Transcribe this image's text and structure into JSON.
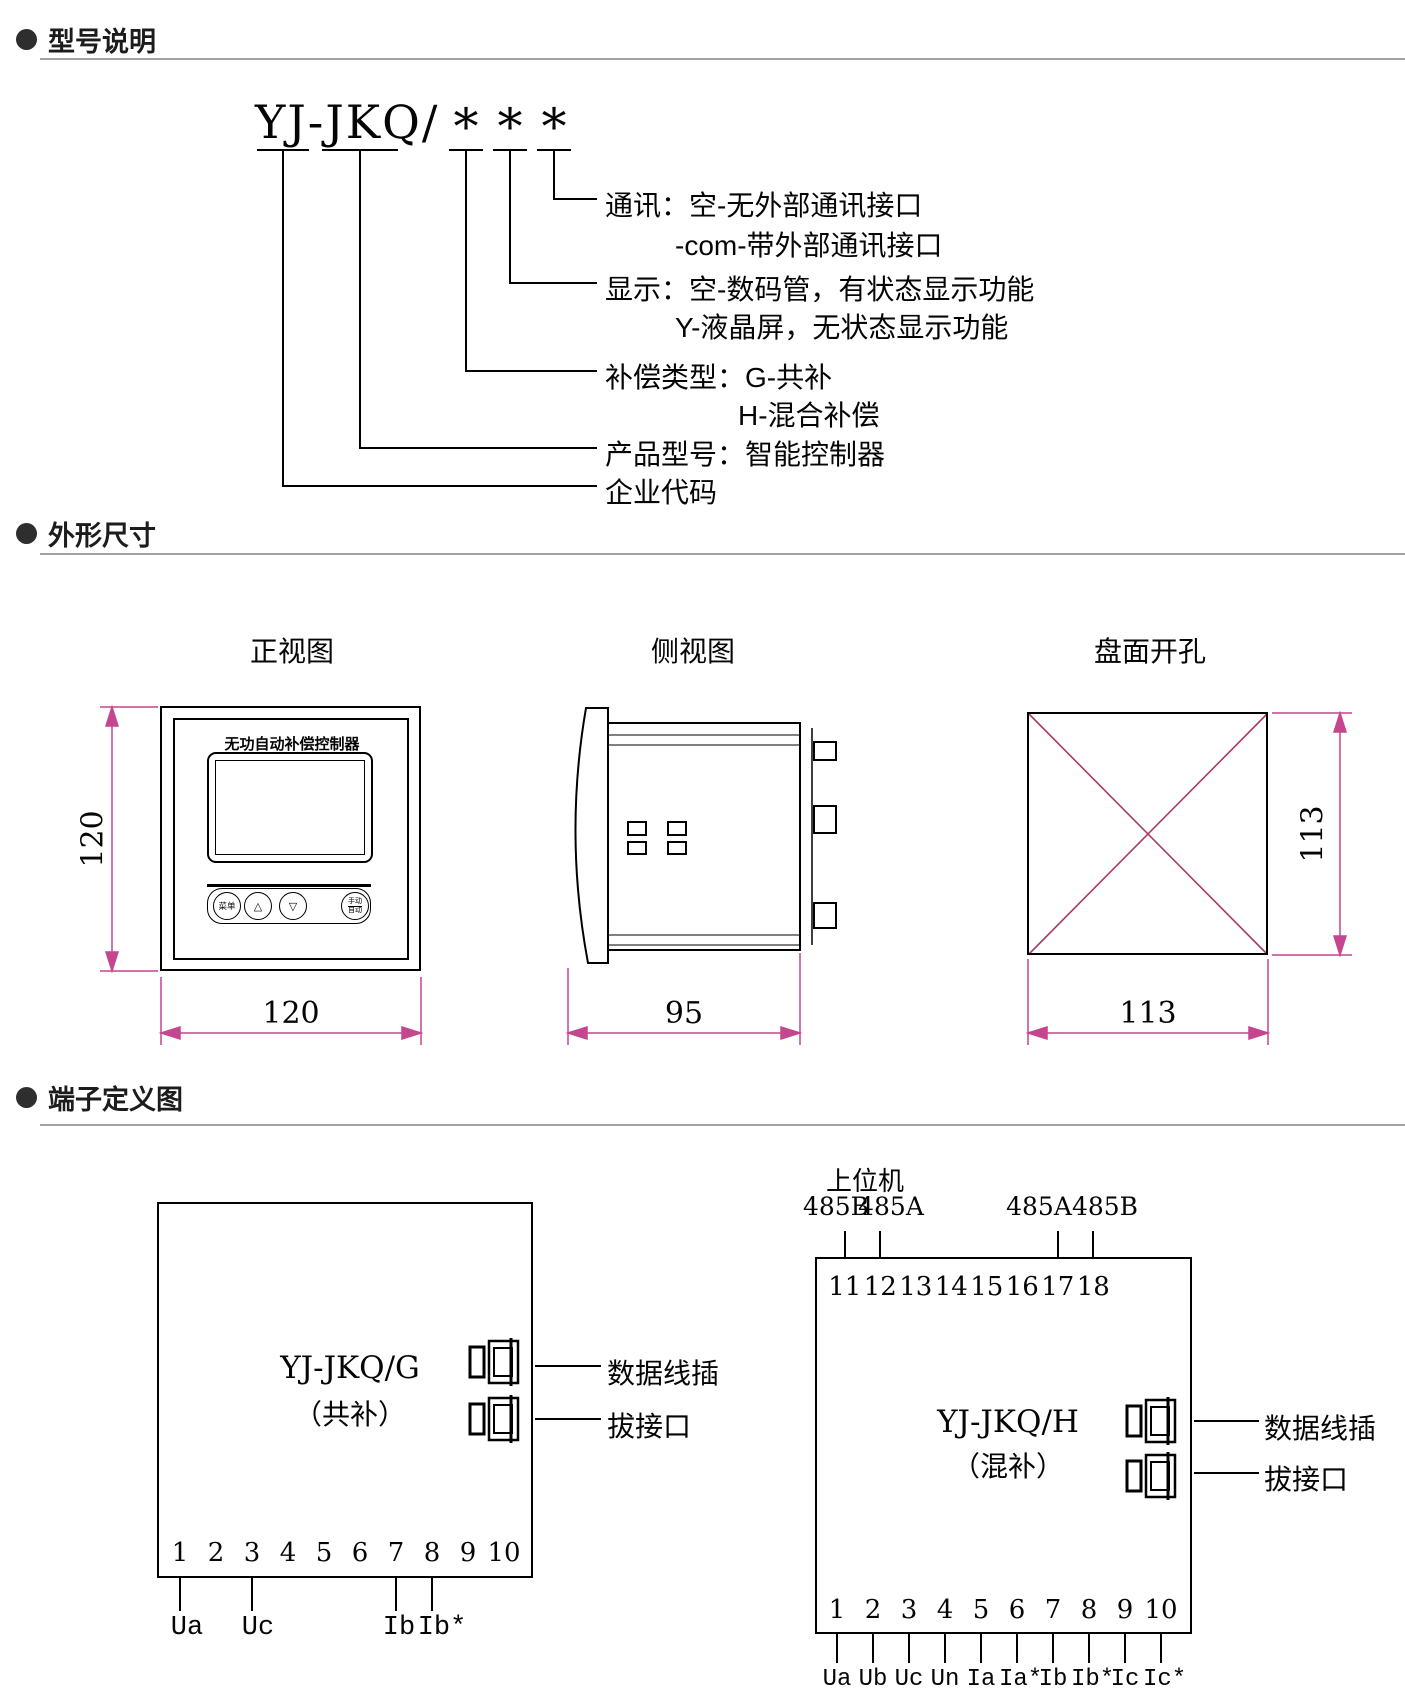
{
  "headers": {
    "model": "型号说明",
    "outline": "外形尺寸",
    "terminal": "端子定义图"
  },
  "model_diagram": {
    "code": "YJ-JKQ/",
    "stars": [
      "*",
      "*",
      "*"
    ],
    "entries": {
      "comm_title": "通讯：空-无外部通讯接口",
      "comm_sub": "-com-带外部通讯接口",
      "disp_title": "显示：空-数码管，有状态显示功能",
      "disp_sub": "Y-液晶屏，无状态显示功能",
      "comp_title": "补偿类型：G-共补",
      "comp_sub": "H-混合补偿",
      "product": "产品型号：智能控制器",
      "company": "企业代码"
    }
  },
  "outline": {
    "front": {
      "title": "正视图",
      "device_label": "无功自动补偿控制器",
      "btn_menu": "菜单",
      "btn_up": "△",
      "btn_down": "▽",
      "btn_manual": "手动",
      "btn_auto": "自动",
      "dim_height": "120",
      "dim_width": "120"
    },
    "side": {
      "title": "侧视图",
      "dim_depth": "95"
    },
    "cutout": {
      "title": "盘面开孔",
      "dim_height": "113",
      "dim_width": "113"
    }
  },
  "terminal_g": {
    "model": "YJ-JKQ/G",
    "type": "（共补）",
    "pins": [
      "1",
      "2",
      "3",
      "4",
      "5",
      "6",
      "7",
      "8",
      "9",
      "10"
    ],
    "pin_labels": [
      {
        "pin": "1",
        "label": "Ua"
      },
      {
        "pin": "3",
        "label": "Uc"
      },
      {
        "pin": "7",
        "label": "Ib"
      },
      {
        "pin": "8",
        "label": "Ib*"
      }
    ],
    "leader1": "数据线插",
    "leader2": "拔接口"
  },
  "terminal_h": {
    "model": "YJ-JKQ/H",
    "type": "（混补）",
    "host": "上位机",
    "top_ports": [
      {
        "label": "485B"
      },
      {
        "label": "485A"
      },
      {
        "label": "485A"
      },
      {
        "label": "485B"
      }
    ],
    "top_pins": [
      "11",
      "12",
      "13",
      "14",
      "15",
      "16",
      "17",
      "18"
    ],
    "pins": [
      "1",
      "2",
      "3",
      "4",
      "5",
      "6",
      "7",
      "8",
      "9",
      "10"
    ],
    "pin_labels": [
      "Ua",
      "Ub",
      "Uc",
      "Un",
      "Ia",
      "Ia*",
      "Ib",
      "Ib*",
      "Ic",
      "Ic*"
    ],
    "leader1": "数据线插",
    "leader2": "拔接口"
  },
  "colors": {
    "dimension": "#c4468f",
    "cutout_x": "#ab3a68",
    "line": "#000000",
    "divider": "#a2a2a2"
  }
}
